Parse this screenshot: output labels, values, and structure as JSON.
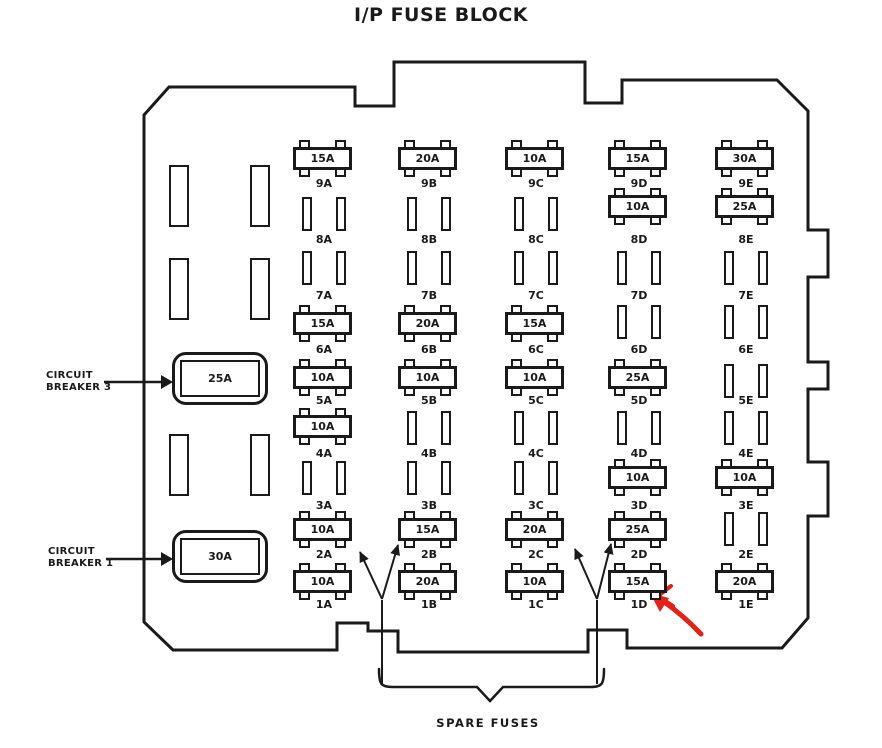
{
  "title": "I/P FUSE BLOCK",
  "spare_fuses_label": "SPARE FUSES",
  "colors": {
    "line": "#1a1a1a",
    "red_arrow": "#e2231a",
    "background": "#ffffff"
  },
  "circuit_breakers": [
    {
      "id": "circuit-breaker-3",
      "line1": "CIRCUIT",
      "line2": "BREAKER 3",
      "amp": "25A"
    },
    {
      "id": "circuit-breaker-1",
      "line1": "CIRCUIT",
      "line2": "BREAKER 1",
      "amp": "30A"
    }
  ],
  "fuse_columns": [
    {
      "id": "A",
      "cells": [
        {
          "pos": "9A",
          "amp": "15A"
        },
        {
          "pos": "8A",
          "amp": ""
        },
        {
          "pos": "7A",
          "amp": ""
        },
        {
          "pos": "6A",
          "amp": "15A"
        },
        {
          "pos": "5A",
          "amp": "10A"
        },
        {
          "pos": "4A",
          "amp": "10A"
        },
        {
          "pos": "3A",
          "amp": ""
        },
        {
          "pos": "2A",
          "amp": "10A"
        },
        {
          "pos": "1A",
          "amp": "10A"
        }
      ]
    },
    {
      "id": "B",
      "cells": [
        {
          "pos": "9B",
          "amp": "20A"
        },
        {
          "pos": "8B",
          "amp": ""
        },
        {
          "pos": "7B",
          "amp": ""
        },
        {
          "pos": "6B",
          "amp": "20A"
        },
        {
          "pos": "5B",
          "amp": "10A"
        },
        {
          "pos": "4B",
          "amp": ""
        },
        {
          "pos": "3B",
          "amp": ""
        },
        {
          "pos": "2B",
          "amp": "15A"
        },
        {
          "pos": "1B",
          "amp": "20A"
        }
      ]
    },
    {
      "id": "C",
      "cells": [
        {
          "pos": "9C",
          "amp": "10A"
        },
        {
          "pos": "8C",
          "amp": ""
        },
        {
          "pos": "7C",
          "amp": ""
        },
        {
          "pos": "6C",
          "amp": "15A"
        },
        {
          "pos": "5C",
          "amp": "10A"
        },
        {
          "pos": "4C",
          "amp": ""
        },
        {
          "pos": "3C",
          "amp": ""
        },
        {
          "pos": "2C",
          "amp": "20A"
        },
        {
          "pos": "1C",
          "amp": "10A"
        }
      ]
    },
    {
      "id": "D",
      "cells": [
        {
          "pos": "9D",
          "amp": "15A"
        },
        {
          "pos": "8D",
          "amp": "10A"
        },
        {
          "pos": "7D",
          "amp": ""
        },
        {
          "pos": "6D",
          "amp": ""
        },
        {
          "pos": "5D",
          "amp": "25A"
        },
        {
          "pos": "4D",
          "amp": ""
        },
        {
          "pos": "3D",
          "amp": "10A"
        },
        {
          "pos": "2D",
          "amp": "25A"
        },
        {
          "pos": "1D",
          "amp": "15A"
        }
      ]
    },
    {
      "id": "E",
      "cells": [
        {
          "pos": "9E",
          "amp": "30A"
        },
        {
          "pos": "8E",
          "amp": "25A"
        },
        {
          "pos": "7E",
          "amp": ""
        },
        {
          "pos": "6E",
          "amp": ""
        },
        {
          "pos": "5E",
          "amp": ""
        },
        {
          "pos": "4E",
          "amp": ""
        },
        {
          "pos": "3E",
          "amp": "10A"
        },
        {
          "pos": "2E",
          "amp": ""
        },
        {
          "pos": "1E",
          "amp": "20A"
        }
      ]
    }
  ],
  "annotations": {
    "red_arrow_target": "1D",
    "spare_fuse_targets": [
      "2A",
      "2B",
      "2C",
      "2D"
    ]
  }
}
